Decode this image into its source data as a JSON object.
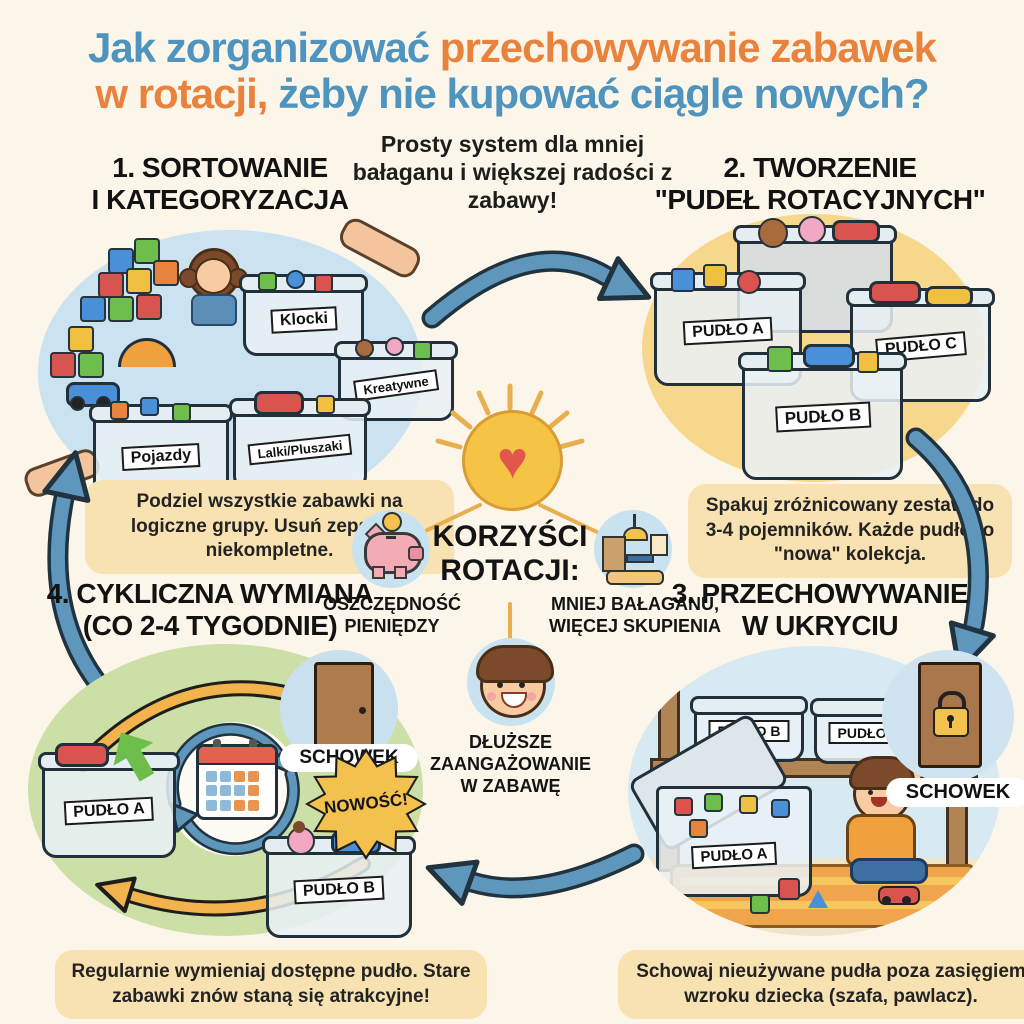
{
  "title": {
    "l1a": "Jak zorganizować ",
    "l1b": "przechowywanie zabawek",
    "l2a": "w rotacji,",
    "l2b": " żeby nie kupować ciągle nowych?"
  },
  "subtitle": "Prosty system dla mniej bałaganu i większej radości z zabawy!",
  "steps": {
    "step1": {
      "header_l1": "1. SORTOWANIE",
      "header_l2": "I KATEGORYZACJA",
      "caption": "Podziel wszystkie zabawki na logiczne grupy. Usuń zepsute i niekompletne.",
      "categories": [
        "Klocki",
        "Pojazdy",
        "Lalki/Pluszaki",
        "Kreatywne"
      ]
    },
    "step2": {
      "header_l1": "2. TWORZENIE",
      "header_l2": "\"PUDEŁ ROTACYJNYCH\"",
      "caption": "Spakuj zróżnicowany zestaw do 3-4 pojemników. Każde pudło to \"nowa\" kolekcja."
    },
    "step3": {
      "header_l1": "3. PRZECHOWYWANIE",
      "header_l2": "W UKRYCIU",
      "caption": "Schowaj nieużywane pudła poza zasięgiem wzroku dziecka (szafa, pawlacz).",
      "storage_label": "SCHOWEK"
    },
    "step4": {
      "header_l1": "4. CYKLICZNA WYMIANA",
      "header_l2": "(CO 2-4 TYGODNIE)",
      "caption": "Regularnie wymieniaj dostępne pudło. Stare zabawki znów staną się atrakcyjne!",
      "storage_label": "SCHOWEK",
      "new_badge": "NOWOŚĆ!"
    }
  },
  "bins": {
    "a": "PUDŁO A",
    "b": "PUDŁO B",
    "c": "PUDŁO C"
  },
  "benefits": {
    "heading": "KORZYŚCI ROTACJI:",
    "heart_icon": "♥",
    "items": [
      {
        "icon": "piggy-bank-icon",
        "label": "OSZCZĘDNOŚĆ PIENIĘDZY"
      },
      {
        "icon": "tidy-room-icon",
        "label": "MNIEJ BAŁAGANU, WIĘCEJ SKUPIENIA"
      },
      {
        "icon": "happy-child-icon",
        "label": "DŁUŻSZE ZAANGAŻOWANIE W ZABAWĘ"
      }
    ]
  },
  "colors": {
    "background": "#FBF6E9",
    "title_blue": "#4E94BE",
    "title_orange": "#E8823C",
    "caption_bg": "#F8E2B2",
    "step1_circle": "#CBE3F0",
    "step2_circle": "#F6D78C",
    "step4_circle": "#CBDFA6",
    "arrow_blue": "#5E96BC",
    "arrow_yellow": "#F2B34C"
  }
}
